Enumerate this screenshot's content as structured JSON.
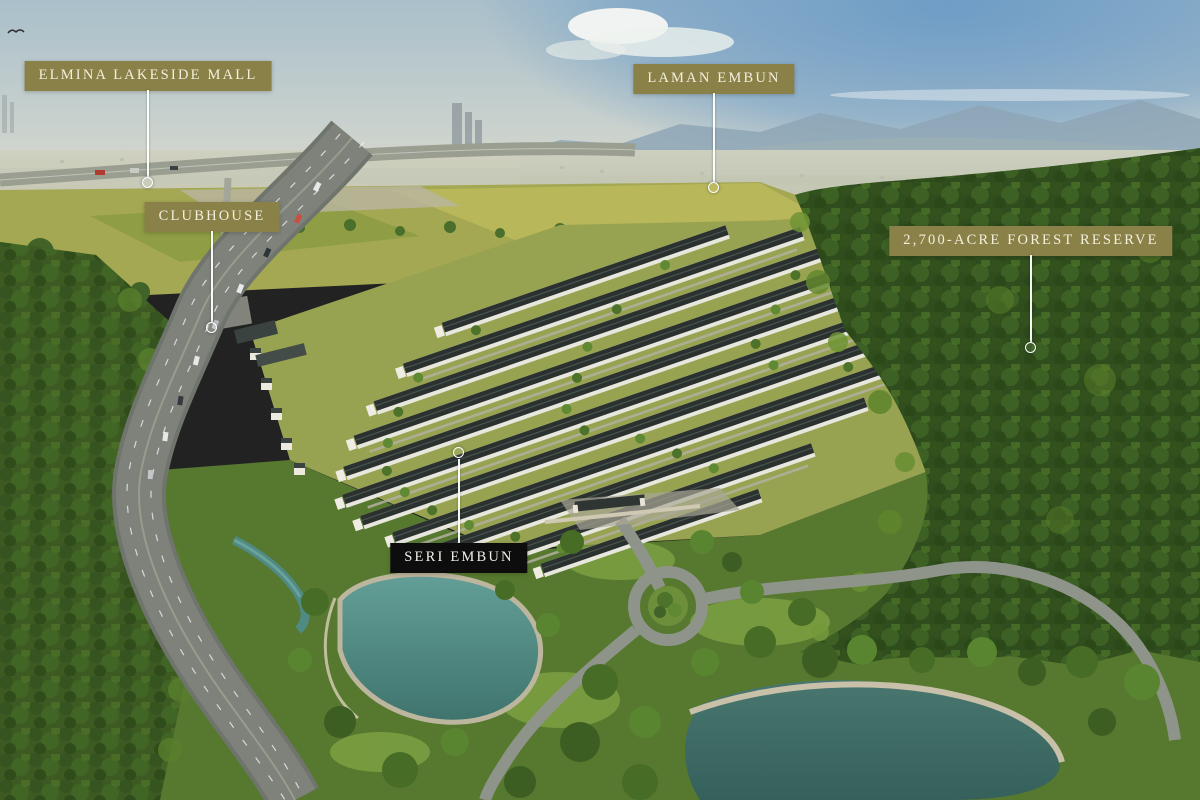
{
  "callouts": [
    {
      "id": "elmina-lakeside-mall",
      "text": "ELMINA LAKESIDE MALL",
      "style": "olive"
    },
    {
      "id": "laman-embun",
      "text": "LAMAN EMBUN",
      "style": "olive"
    },
    {
      "id": "clubhouse",
      "text": "CLUBHOUSE",
      "style": "olive"
    },
    {
      "id": "forest-reserve",
      "text": "2,700-ACRE FOREST RESERVE",
      "style": "olive"
    },
    {
      "id": "seri-embun",
      "text": "SERI EMBUN",
      "style": "dark"
    }
  ],
  "colors": {
    "callout_olive": "#8a8148",
    "callout_dark": "#0d0d0d",
    "callout_text": "#f3efdd",
    "leader_line": "#ffffff",
    "sky_top": "#a9bfca",
    "sky_blue": "#6f9dc6",
    "haze": "#cfd0bf",
    "field_yellow_green": "#a5a852",
    "forest_dark": "#2f4d1d",
    "roof_dark": "#2a312f",
    "road_gray": "#7e827a",
    "lake_teal": "#4f8d85"
  }
}
